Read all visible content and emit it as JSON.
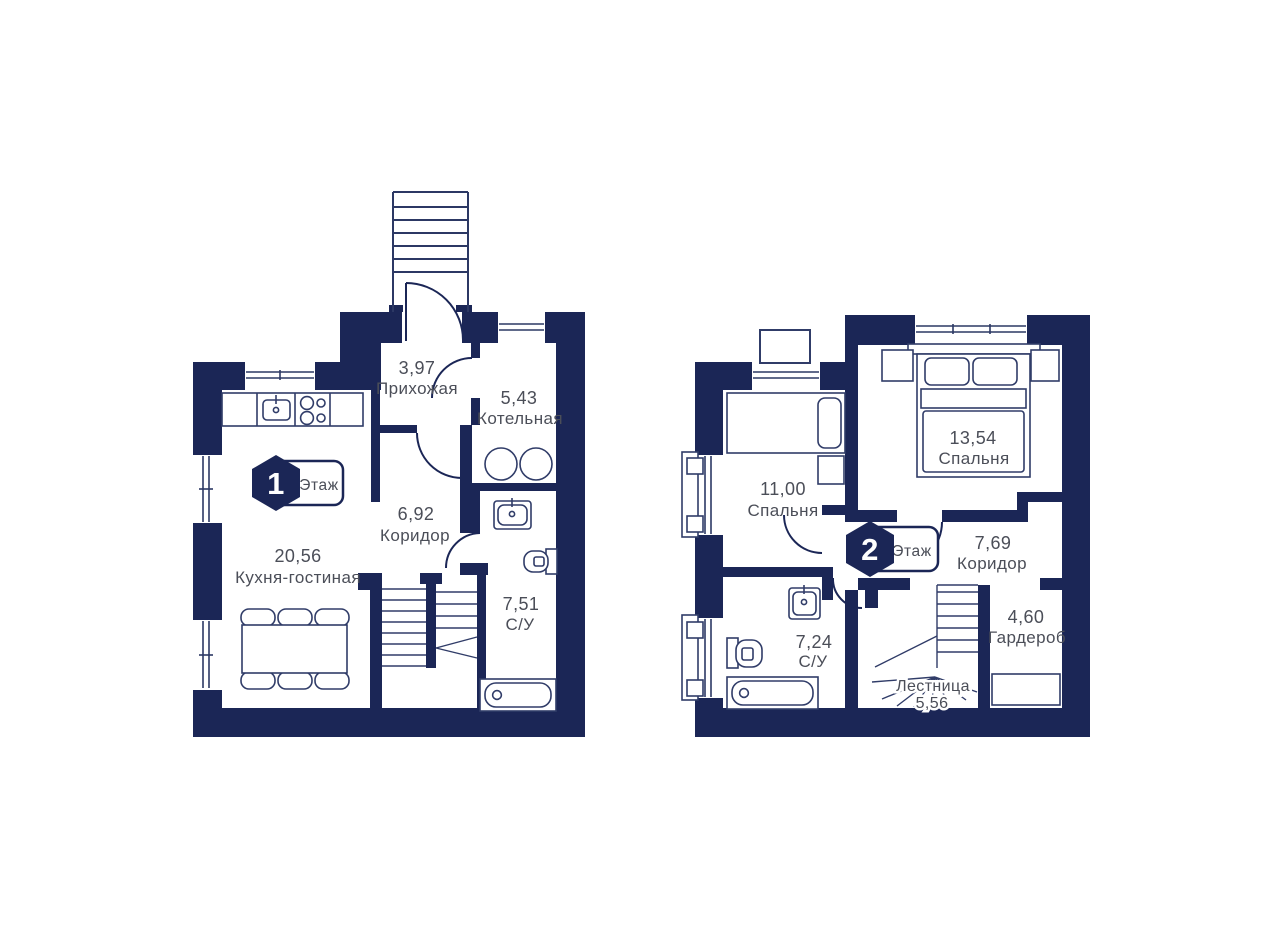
{
  "plan": {
    "colors": {
      "wall": "#1b2656",
      "furniture_line": "#303c68",
      "label_text": "#4b4e58",
      "background": "#ffffff"
    },
    "floor1": {
      "badge": {
        "number": "1",
        "label": "Этаж"
      },
      "rooms": [
        {
          "id": "hallway",
          "area": "3,97",
          "name": "Прихожая"
        },
        {
          "id": "boiler-room",
          "area": "5,43",
          "name": "Котельная"
        },
        {
          "id": "corridor",
          "area": "6,92",
          "name": "Коридор"
        },
        {
          "id": "kitchen-living",
          "area": "20,56",
          "name": "Кухня-гостиная"
        },
        {
          "id": "bathroom",
          "area": "7,51",
          "name": "С/У"
        }
      ]
    },
    "floor2": {
      "badge": {
        "number": "2",
        "label": "Этаж"
      },
      "rooms": [
        {
          "id": "bedroom-small",
          "area": "11,00",
          "name": "Спальня"
        },
        {
          "id": "bedroom-big",
          "area": "13,54",
          "name": "Спальня"
        },
        {
          "id": "corridor",
          "area": "7,69",
          "name": "Коридор"
        },
        {
          "id": "wardrobe",
          "area": "4,60",
          "name": "Гардероб"
        },
        {
          "id": "bathroom",
          "area": "7,24",
          "name": "С/У"
        },
        {
          "id": "staircase",
          "name": "Лестница",
          "area": "5,56"
        }
      ]
    }
  }
}
